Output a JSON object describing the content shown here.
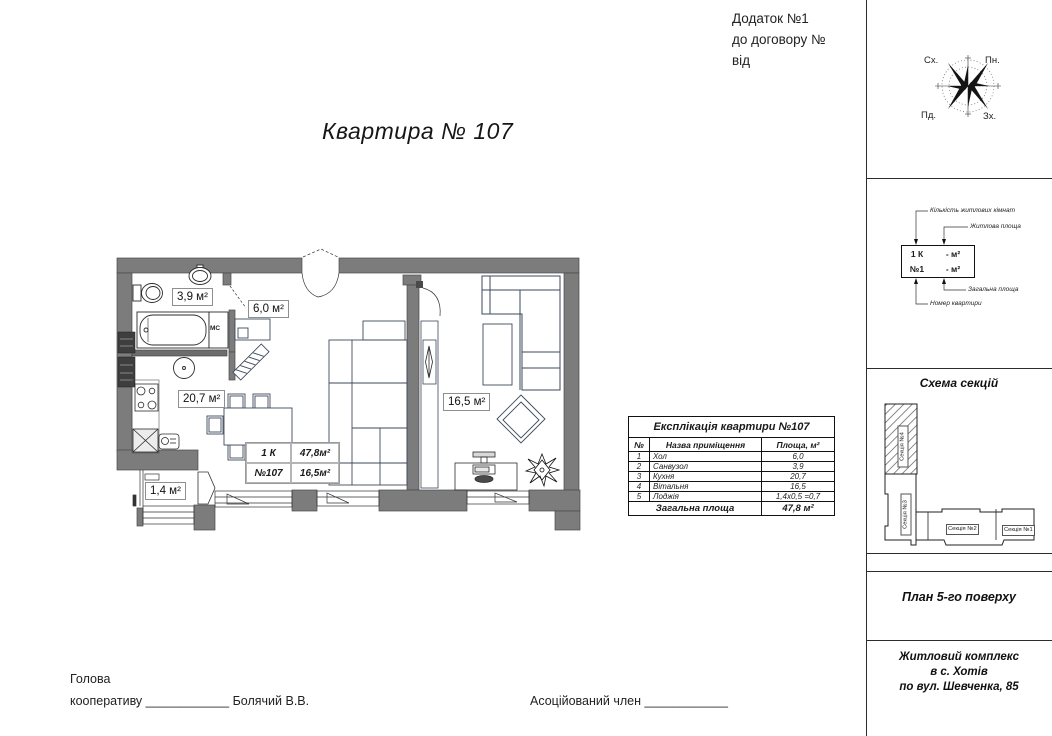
{
  "header": {
    "annex_line1": "Додаток №1",
    "annex_line2": "до договору №",
    "annex_line3": "від",
    "title": "Квартира № 107"
  },
  "compass": {
    "nw": "Сх.",
    "ne": "Пн.",
    "sw": "Пд.",
    "se": "Зх."
  },
  "legend": {
    "label_rooms": "Кількість житлових кімнат",
    "label_living_area": "Житлова площа",
    "label_total_area": "Загальна площа",
    "label_apt_number": "Номер квартири",
    "box_r1_left": "1 К",
    "box_r1_right": "- м²",
    "box_r2_left": "№1",
    "box_r2_right": "- м²"
  },
  "plan": {
    "rooms": {
      "bathroom": "3,9 м²",
      "hall": "6,0 м²",
      "kitchen": "20,7 м²",
      "living": "16,5 м²",
      "loggia": "1,4 м²"
    },
    "mc_label": "МС",
    "info_box": {
      "r1c1": "1 К",
      "r1c2": "47,8м²",
      "r2c1": "№107",
      "r2c2": "16,5м²"
    }
  },
  "table": {
    "title": "Експлікація квартири №107",
    "headers": [
      "№",
      "Назва приміщення",
      "Площа, м²"
    ],
    "rows": [
      {
        "num": "1",
        "name": "Хол",
        "area": "6,0"
      },
      {
        "num": "2",
        "name": "Санвузол",
        "area": "3,9"
      },
      {
        "num": "3",
        "name": "Кухня",
        "area": "20,7"
      },
      {
        "num": "4",
        "name": "Вітальня",
        "area": "16,5"
      },
      {
        "num": "5",
        "name": "Лоджія",
        "area": "1,4х0,5 =0,7"
      }
    ],
    "footer": {
      "label": "Загальна площа",
      "value": "47,8 м²"
    }
  },
  "sections_scheme": {
    "title": "Схема секцій",
    "section4": "Секція №4",
    "section3": "Секція №3",
    "section2": "Секція №2",
    "section1": "Секція №1"
  },
  "sidebar": {
    "floor_label": "План 5-го поверху",
    "complex_line1": "Житловий комплекс",
    "complex_line2": "в с. Хотів",
    "complex_line3": "по вул. Шевченка, 85"
  },
  "signatures": {
    "left_line1": "Голова",
    "left_line2": "кооперативу",
    "left_underscores": "____________",
    "left_name": "Болячий В.В.",
    "right_label": "Асоційований член",
    "right_underscores": "____________"
  },
  "colors": {
    "wall": "#7c7c7c",
    "wall_edge": "#4a4a4a",
    "furniture": "#3d4a5c"
  }
}
